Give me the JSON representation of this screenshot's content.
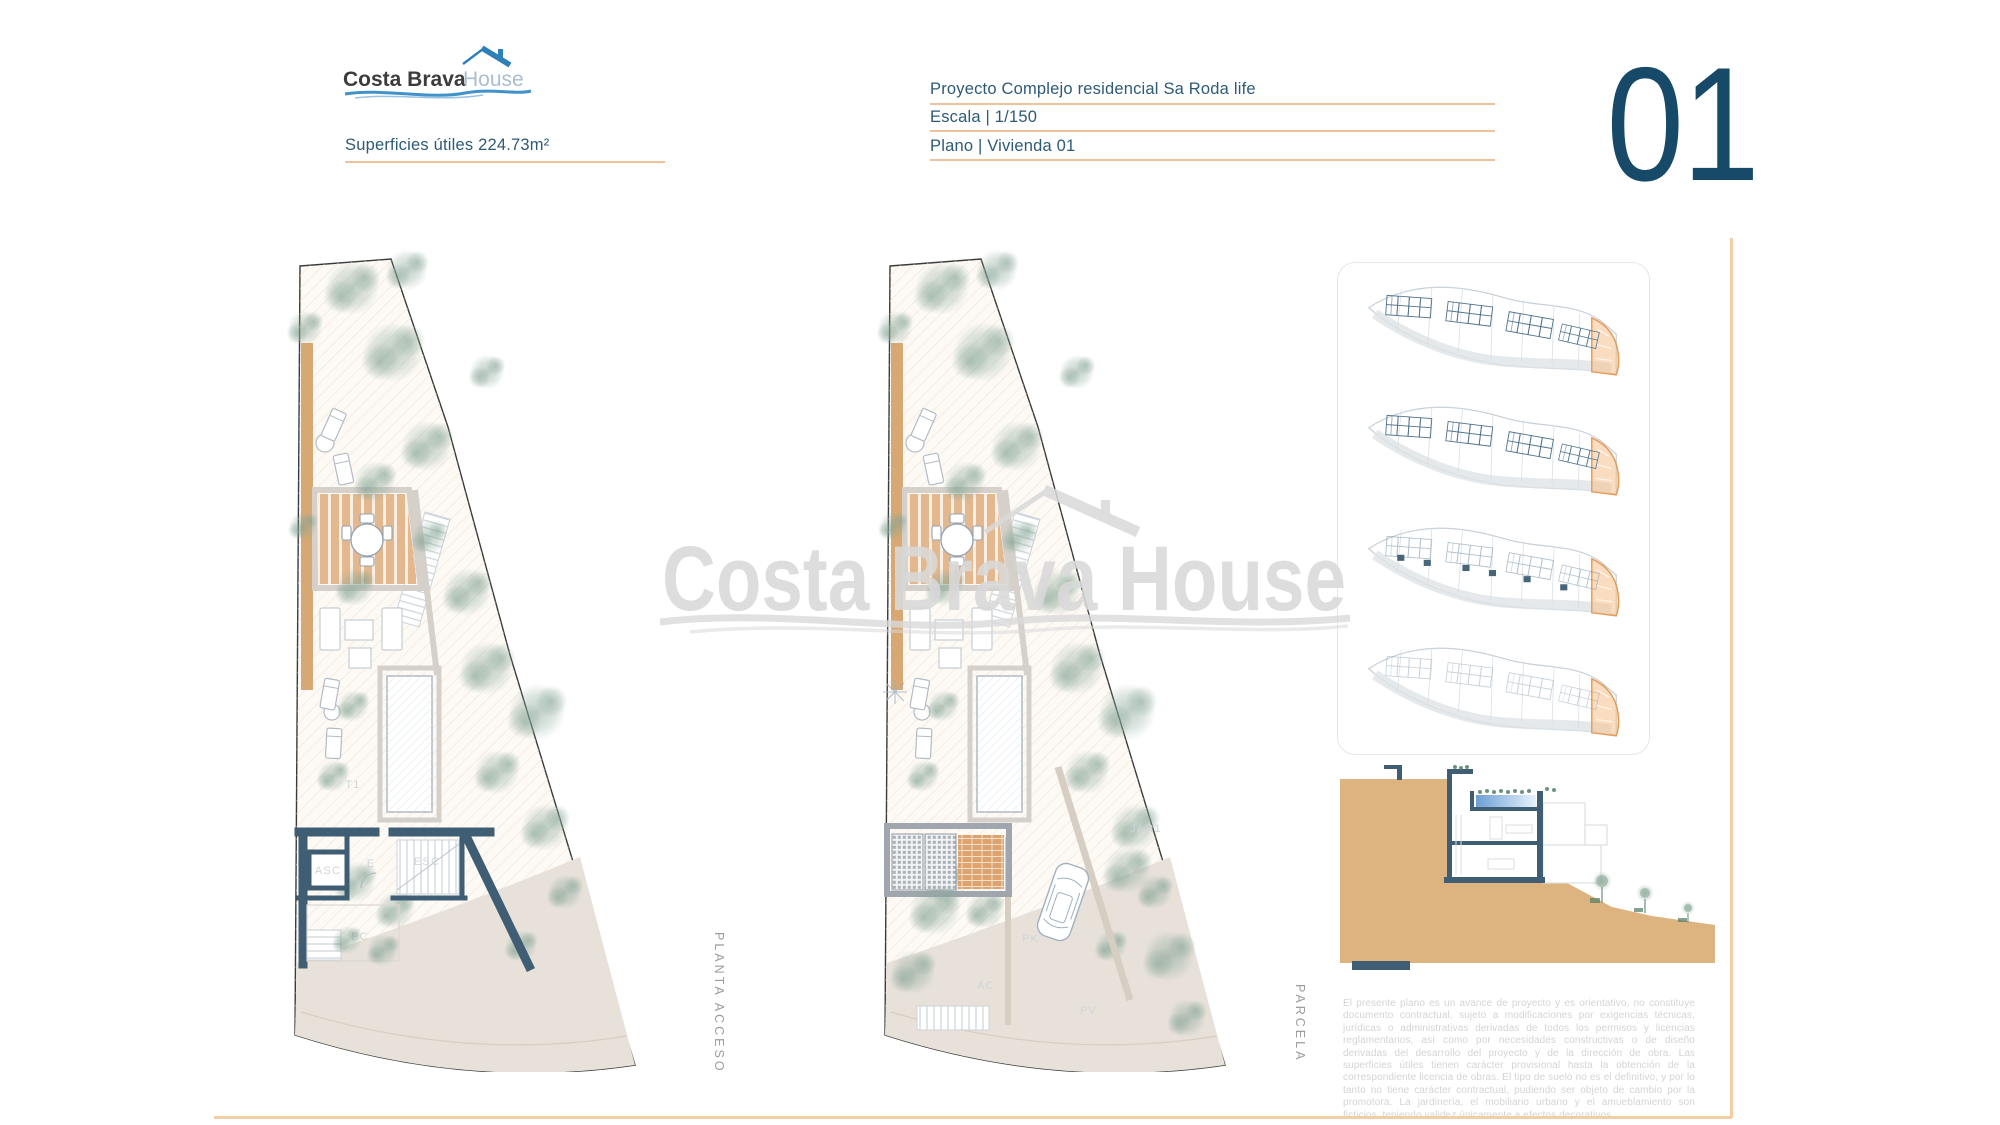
{
  "colors": {
    "accent_underline": "#f0c29a",
    "border_orange": "#f3cda6",
    "heading_teal": "#2d5a75",
    "sheet_number_blue": "#174a68",
    "logo_blue": "#2f80b9",
    "logo_dark": "#3c3c3c",
    "logo_light_blue": "#a9bed2",
    "watermark_gray": "#d9d9d9",
    "wall_slate": "#3f5e73",
    "terrain_tan": "#ddb480",
    "deck_wood": "#e3b88e",
    "site_highlight_orange": "#f5c18c",
    "tree_green": "#87a696",
    "road_beige": "#e7e1da"
  },
  "logo": {
    "brand_dark": "Costa Brava",
    "brand_light": "House"
  },
  "header": {
    "superficies_label": "Superficies útiles  224.73m²",
    "project_line": "Proyecto Complejo residencial Sa Roda life",
    "scale_line": "Escala | 1/150",
    "plano_line": "Plano | Vivienda 01",
    "sheet_number": "01"
  },
  "watermark": {
    "text": "Costa Brava House"
  },
  "plans": {
    "left": {
      "caption": "PLANTA ACCESO",
      "labels": {
        "t1": "T1",
        "asc": "ASC",
        "e": "E",
        "esc": "ESC",
        "pc": "PC"
      }
    },
    "middle": {
      "caption": "PARCELA",
      "labels": {
        "jar1": "JAR1",
        "pk": "PK",
        "ac": "AC",
        "pv": "PV"
      }
    }
  },
  "disclaimer": "El presente plano es un avance de proyecto y es orientativo, no constituye documento contractual, sujeto a modificaciones por exigencias técnicas, jurídicas o administrativas derivadas de todos los permisos y licencias reglamentarios, así como por necesidades constructivas o de diseño derivadas del desarrollo del proyecto y de la dirección de obra. Las superficies útiles tienen carácter provisional hasta la obtención de la correspondiente licencia de obras. El tipo de suelo no es el definitivo, y por lo tanto no tiene carácter contractual, pudiendo ser objeto de cambio por la promotora. La jardinería, el mobiliario urbano y el amueblamiento son ficticios, teniendo validez únicamente a efectos decorativos."
}
